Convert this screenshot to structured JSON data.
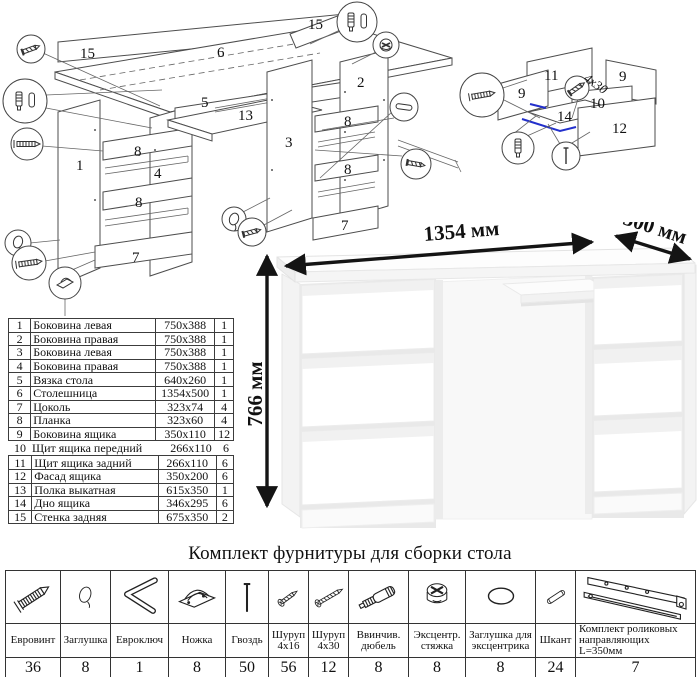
{
  "kit": {
    "title": "Комплект фурнитуры для сборки стола",
    "items": [
      {
        "name": "Евровинт",
        "qty": "36"
      },
      {
        "name": "Заглушка",
        "qty": "8"
      },
      {
        "name": "Евроключ",
        "qty": "1"
      },
      {
        "name": "Ножка",
        "qty": "8"
      },
      {
        "name": "Гвоздь",
        "qty": "50"
      },
      {
        "name": "Шуруп 4x16",
        "qty": "56"
      },
      {
        "name": "Шуруп 4x30",
        "qty": "12"
      },
      {
        "name": "Ввинчив. дюбель",
        "qty": "8"
      },
      {
        "name": "Эксцентр. стяжка",
        "qty": "8"
      },
      {
        "name": "Заглушка для эксцентрика",
        "qty": "8"
      },
      {
        "name": "Шкант",
        "qty": "24"
      },
      {
        "name": "Комплект роликовых направляющих L=350мм",
        "qty": "7"
      }
    ]
  },
  "parts": {
    "rows": [
      [
        "1",
        "Боковина левая",
        "750x388",
        "1"
      ],
      [
        "2",
        "Боковина правая",
        "750x388",
        "1"
      ],
      [
        "3",
        "Боковина левая",
        "750x388",
        "1"
      ],
      [
        "4",
        "Боковина правая",
        "750x388",
        "1"
      ],
      [
        "5",
        "Вязка стола",
        "640x260",
        "1"
      ],
      [
        "6",
        "Столешница",
        "1354x500",
        "1"
      ],
      [
        "7",
        "Цоколь",
        "323x74",
        "4"
      ],
      [
        "8",
        "Планка",
        "323x60",
        "4"
      ],
      [
        "9",
        "Боковина ящика",
        "350x110",
        "12"
      ],
      [
        "10",
        "Щит ящика передний",
        "266x110",
        "6"
      ],
      [
        "11",
        "Щит ящика задний",
        "266x110",
        "6"
      ],
      [
        "12",
        "Фасад ящика",
        "350x200",
        "6"
      ],
      [
        "13",
        "Полка выкатная",
        "615x350",
        "1"
      ],
      [
        "14",
        "Дно ящика",
        "346x295",
        "6"
      ],
      [
        "15",
        "Стенка задняя",
        "675x350",
        "2"
      ]
    ]
  },
  "desk": {
    "width": "1354 мм",
    "depth": "500 мм",
    "height": "766 мм"
  },
  "diagrams": {
    "main": {
      "labels": [
        "15",
        "6",
        "15",
        "5",
        "13",
        "1",
        "8",
        "4",
        "8",
        "7",
        "3",
        "2",
        "8",
        "8",
        "7"
      ]
    },
    "drawer": {
      "labels": [
        "11",
        "9",
        "9",
        "10",
        "14",
        "12"
      ],
      "annotation": "4x30"
    }
  }
}
